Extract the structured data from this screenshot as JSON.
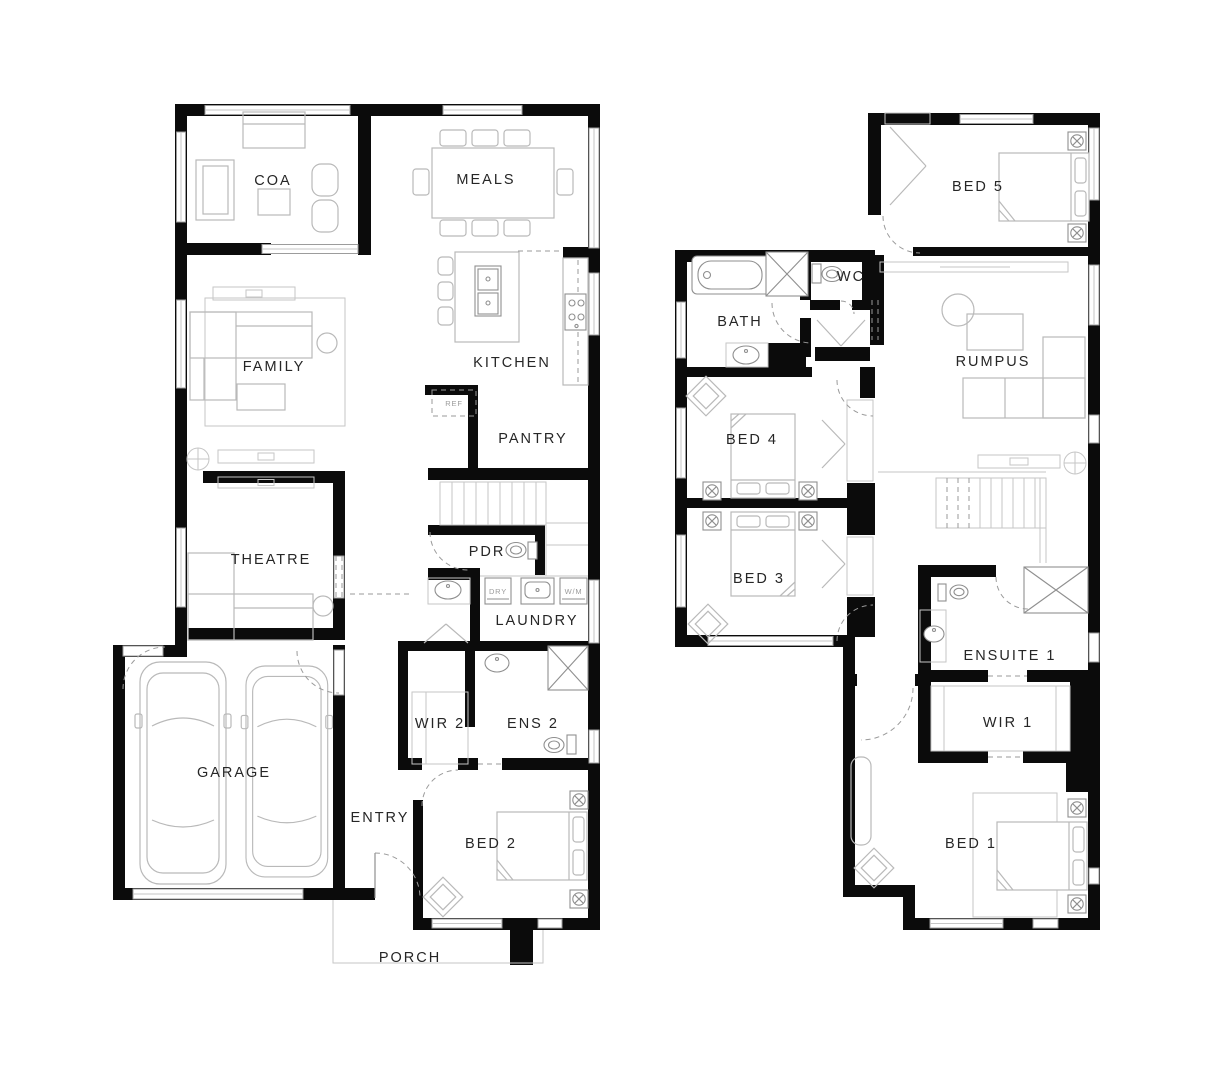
{
  "colors": {
    "background": "#ffffff",
    "wall": "#0b0b0b",
    "furniture_line": "#b9b9b9",
    "fixture_line": "#8f8f8f",
    "label_text": "#262626",
    "mini_label_text": "#9b9b9b"
  },
  "ground_floor": {
    "rooms": {
      "coa": "COA",
      "meals": "MEALS",
      "family": "FAMILY",
      "kitchen": "KITCHEN",
      "pantry": "PANTRY",
      "theatre": "THEATRE",
      "pdr": "PDR",
      "laundry": "LAUNDRY",
      "wir2": "WIR 2",
      "ens2": "ENS 2",
      "garage": "GARAGE",
      "entry": "ENTRY",
      "bed2": "BED 2",
      "porch": "PORCH"
    },
    "appliances": {
      "ref": "REF",
      "dry": "DRY",
      "wm": "W/M"
    }
  },
  "first_floor": {
    "rooms": {
      "bed5": "BED 5",
      "wc": "WC",
      "bath": "BATH",
      "rumpus": "RUMPUS",
      "bed4": "BED 4",
      "bed3": "BED 3",
      "ensuite1": "ENSUITE 1",
      "wir1": "WIR 1",
      "bed1": "BED 1"
    }
  }
}
